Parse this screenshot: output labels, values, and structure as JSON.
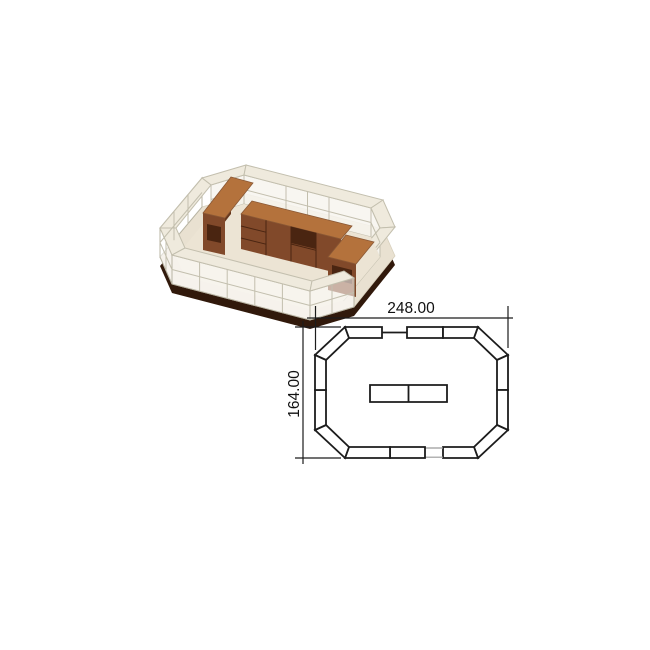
{
  "plan": {
    "width_label": "248.00",
    "height_label": "164.00"
  },
  "colors": {
    "plan-line": "#1c1c1c",
    "plan-gap-line": "#9a9a9a",
    "dim-text": "#111111",
    "base-dark": "#31190b",
    "platform": "#e9e1d1",
    "floor": "#ece4d4",
    "counter-top": "#efeadd",
    "frame-line": "#c3bfae",
    "wood-top": "#b4723c",
    "wood-front": "#81492a",
    "wood-side": "#66371c",
    "wood-dark": "#4a2511"
  }
}
